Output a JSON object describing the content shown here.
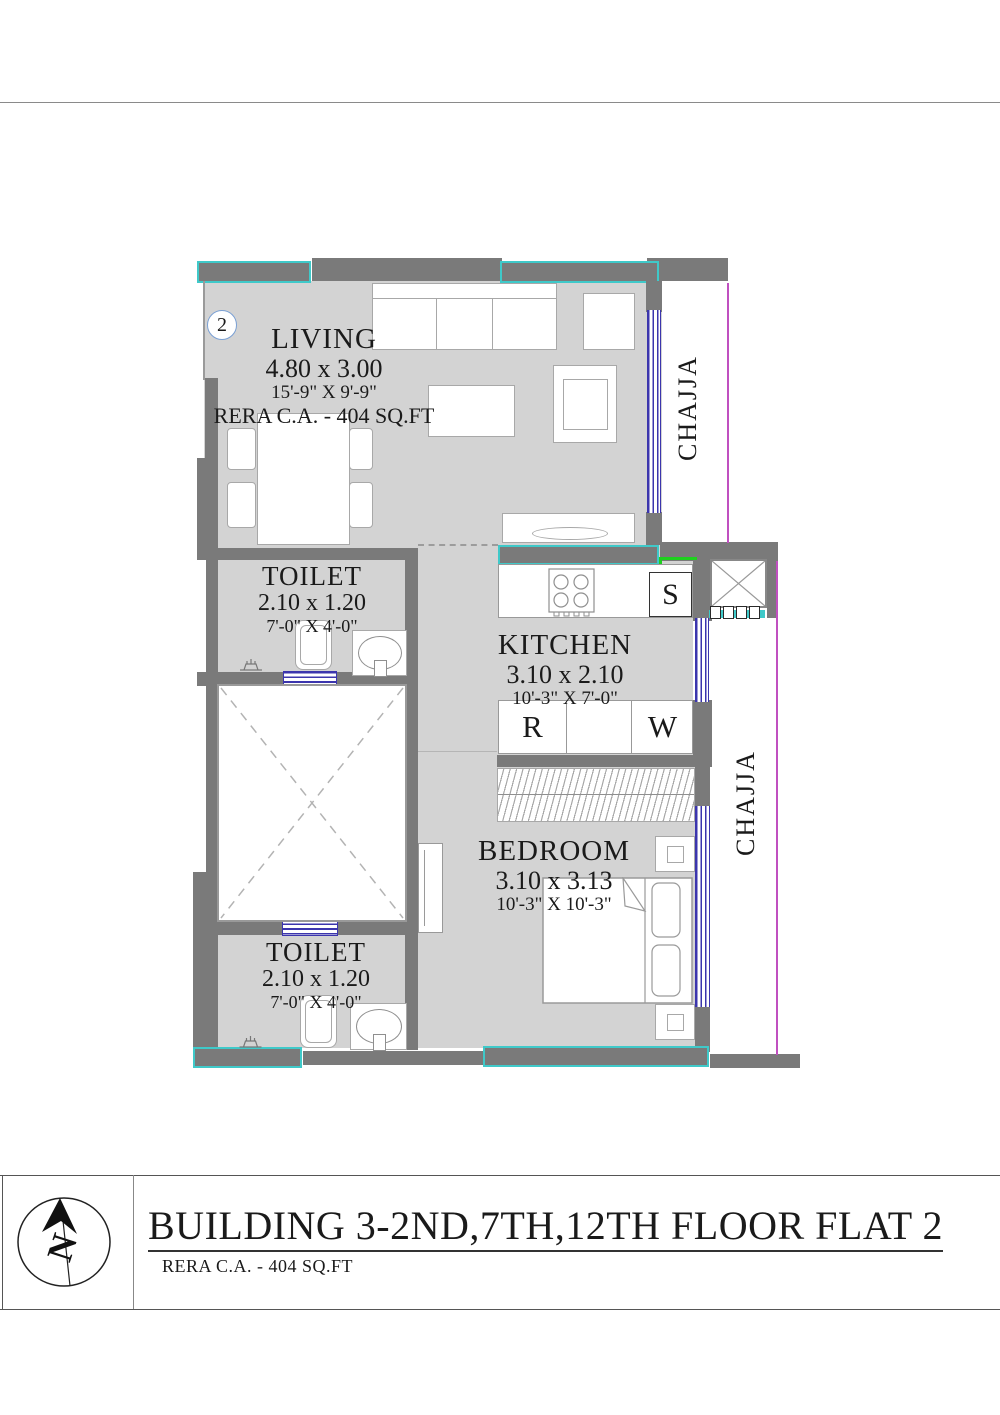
{
  "plan": {
    "unit_number": "2",
    "living": {
      "name": "LIVING",
      "dim_m": "4.80 x 3.00",
      "dim_ft": "15'-9\" X 9'-9\"",
      "rera": "RERA C.A. - 404 SQ.FT"
    },
    "toilet_top": {
      "name": "TOILET",
      "dim_m": "2.10 x 1.20",
      "dim_ft": "7'-0\" X 4'-0\""
    },
    "kitchen": {
      "name": "KITCHEN",
      "dim_m": "3.10 x 2.10",
      "dim_ft": "10'-3\" X 7'-0\""
    },
    "bedroom": {
      "name": "BEDROOM",
      "dim_m": "3.10 x 3.13",
      "dim_ft": "10'-3\" X 10'-3\""
    },
    "toilet_bottom": {
      "name": "TOILET",
      "dim_m": "2.10 x 1.20",
      "dim_ft": "7'-0\" X 4'-0\""
    },
    "chajja_top": "CHAJJA",
    "chajja_bottom": "CHAJJA",
    "appliances": {
      "sink": "S",
      "fridge": "R",
      "washer": "W"
    }
  },
  "title_block": {
    "title": "BUILDING 3-2ND,7TH,12TH FLOOR FLAT 2",
    "subtitle": "RERA C.A. - 404 SQ.FT",
    "north_label": "N"
  },
  "colors": {
    "wall": "#7a7a7a",
    "floor": "#d3d3d3",
    "cyan": "#3fc9c9",
    "magenta": "#c050c0",
    "winblue": "#3b35ad",
    "green": "#1fd11f",
    "circleblue": "#7aa0d4",
    "furnline": "#999999",
    "ink": "#1a1a1a"
  }
}
